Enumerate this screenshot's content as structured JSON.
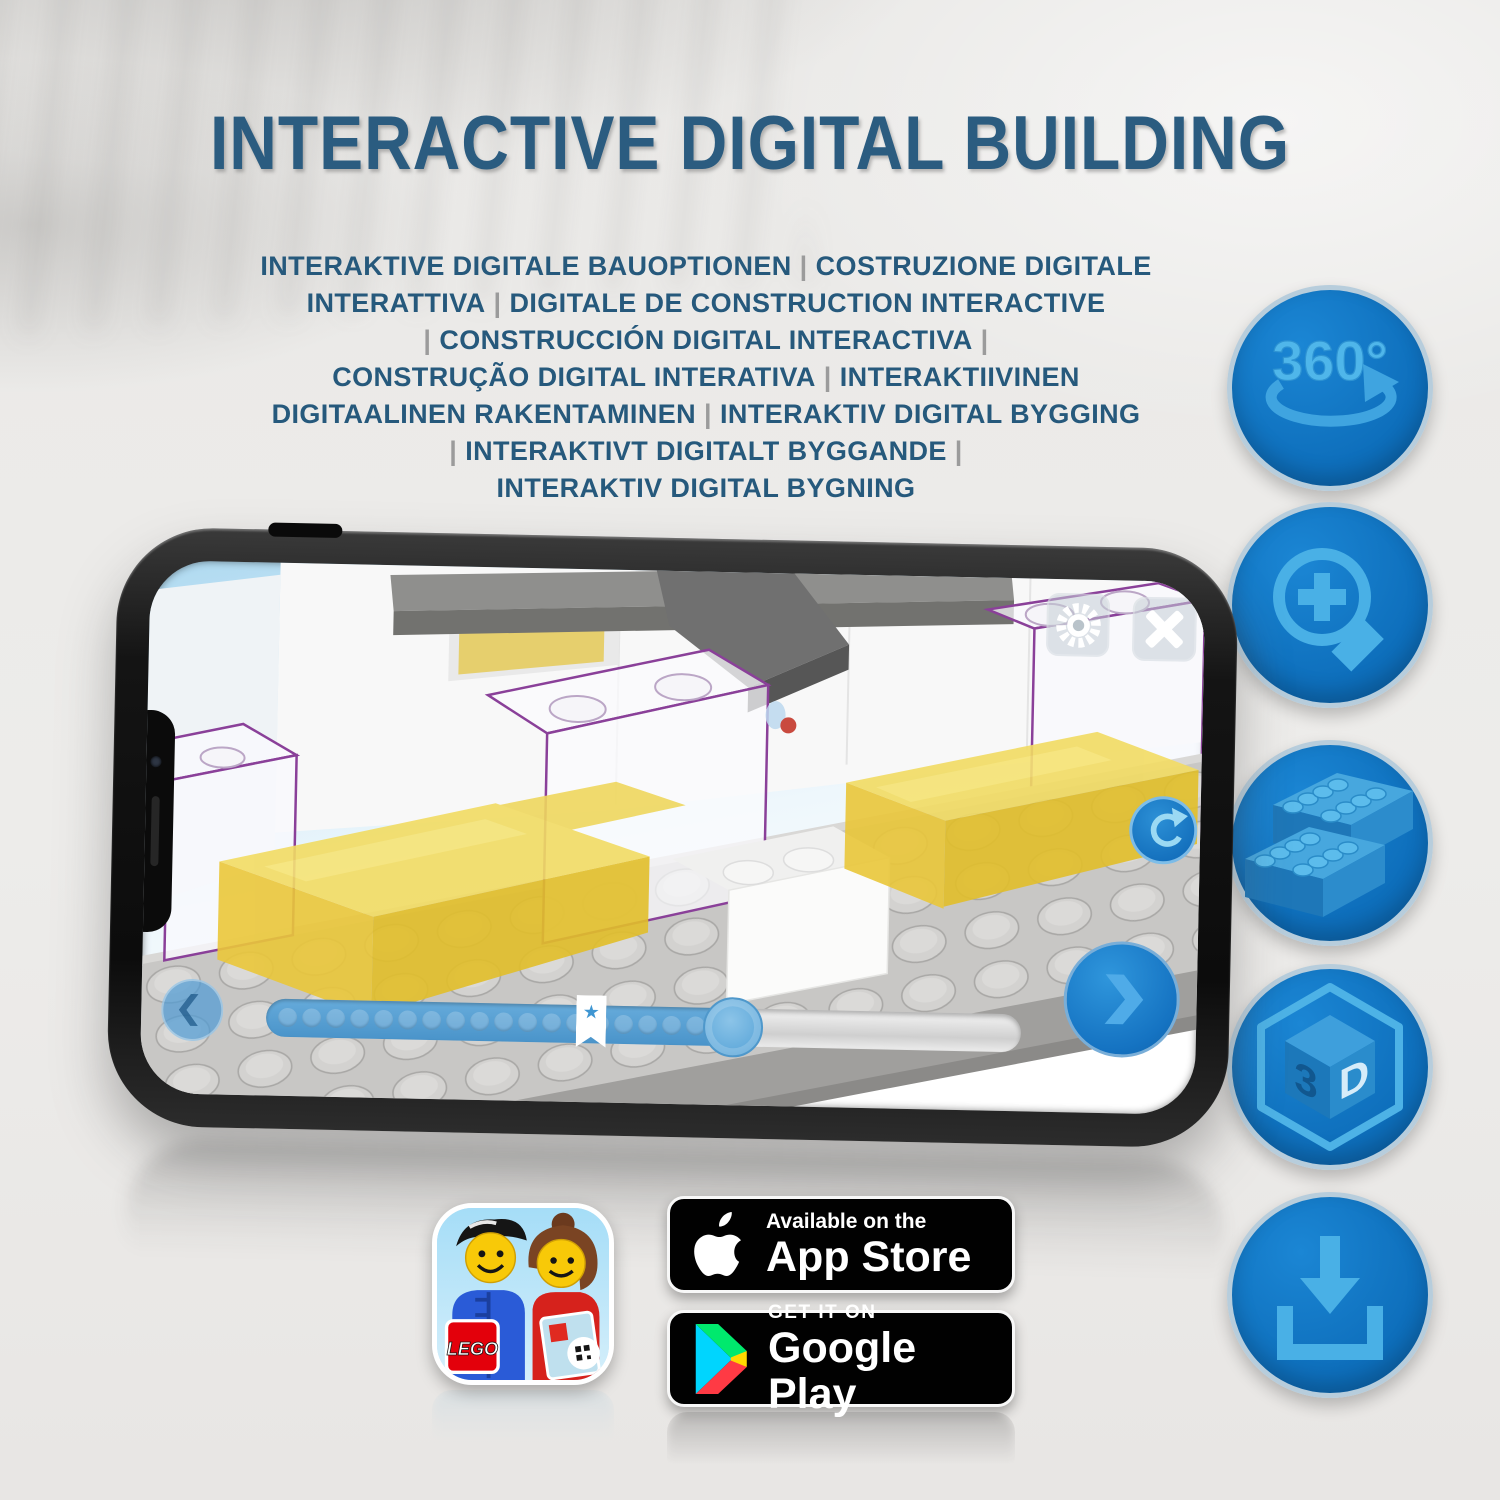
{
  "title": "INTERACTIVE DIGITAL BUILDING",
  "subtitle_lines": [
    "INTERAKTIVE DIGITALE BAUOPTIONEN | COSTRUZIONE DIGITALE",
    "INTERATTIVA | DIGITALE DE CONSTRUCTION INTERACTIVE",
    "| CONSTRUCCIÓN DIGITAL INTERACTIVA |",
    "CONSTRUÇÃO DIGITAL INTERATIVA | INTERAKTIIVINEN",
    "DIGITAALINEN RAKENTAMINEN | INTERAKTIV DIGITAL BYGGING",
    "| INTERAKTIVT DIGITALT BYGGANDE |",
    "INTERAKTIV DIGITAL BYGNING"
  ],
  "feature_rail": {
    "items": [
      {
        "icon": "rotation-360-icon",
        "label": "360°"
      },
      {
        "icon": "zoom-in-icon"
      },
      {
        "icon": "brick-stack-icon"
      },
      {
        "icon": "3d-cube-icon",
        "left_letter": "3",
        "right_letter": "D"
      },
      {
        "icon": "download-icon"
      }
    ]
  },
  "phone": {
    "screen_icons": {
      "settings": "gear-icon",
      "close": "close-icon",
      "rotate": "rotate-arrow-icon",
      "previous": "chevron-left-icon",
      "next": "chevron-right-icon",
      "bookmark": "star-bookmark-icon"
    },
    "slider": {
      "dot_count": 19,
      "star_glyph": "★"
    }
  },
  "badges": {
    "lego_app": {
      "logo_text": "LEGO"
    },
    "app_store": {
      "tagline": "Available on the",
      "name": "App Store",
      "icon": "apple-icon"
    },
    "google_play": {
      "tagline": "GET IT ON",
      "name": "Google Play",
      "icon": "google-play-triangle-icon"
    }
  },
  "colors": {
    "title_blue": "#2b5c80",
    "circle_blue": "#0e72c0",
    "glyph_blue": "#49b0e6",
    "lego_yellow": "#f0d95a",
    "slider_blue": "#559fd3"
  }
}
